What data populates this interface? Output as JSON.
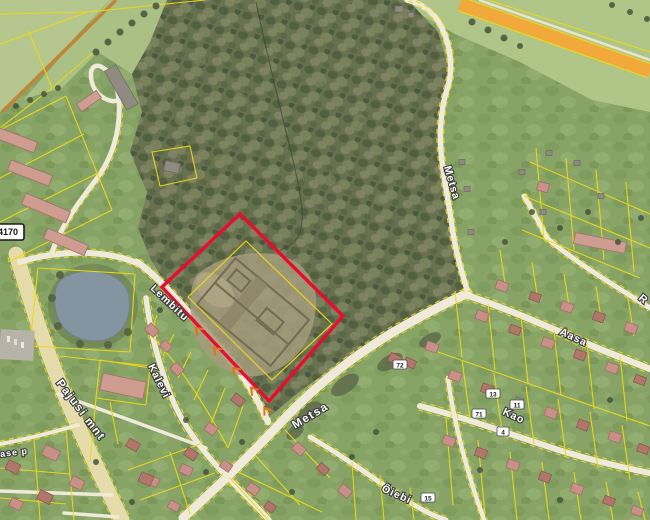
{
  "streets": [
    {
      "id": "lembitu",
      "name": "Lembitu"
    },
    {
      "id": "kalevi",
      "name": "Kalevi"
    },
    {
      "id": "pajusi-mnt",
      "name": "Pajusi mnt"
    },
    {
      "id": "metsa-lower",
      "name": "Metsa"
    },
    {
      "id": "metsa-upper",
      "name": "Metsa"
    },
    {
      "id": "aasa",
      "name": "Aasa"
    },
    {
      "id": "kao",
      "name": "Kao"
    },
    {
      "id": "oiebi-partial",
      "name": "Õiebi"
    },
    {
      "id": "kase-partial",
      "name": "Kase p"
    },
    {
      "id": "r-partial",
      "name": "R"
    }
  ],
  "road_sign": {
    "number": "4170"
  },
  "house_numbers": [
    {
      "text": "72"
    },
    {
      "text": "13"
    },
    {
      "text": "11"
    },
    {
      "text": "71"
    },
    {
      "text": "4"
    },
    {
      "text": "15"
    }
  ],
  "legend": {
    "highlight_color": "#ea0c2e",
    "cadastral_color": "#eed815"
  }
}
